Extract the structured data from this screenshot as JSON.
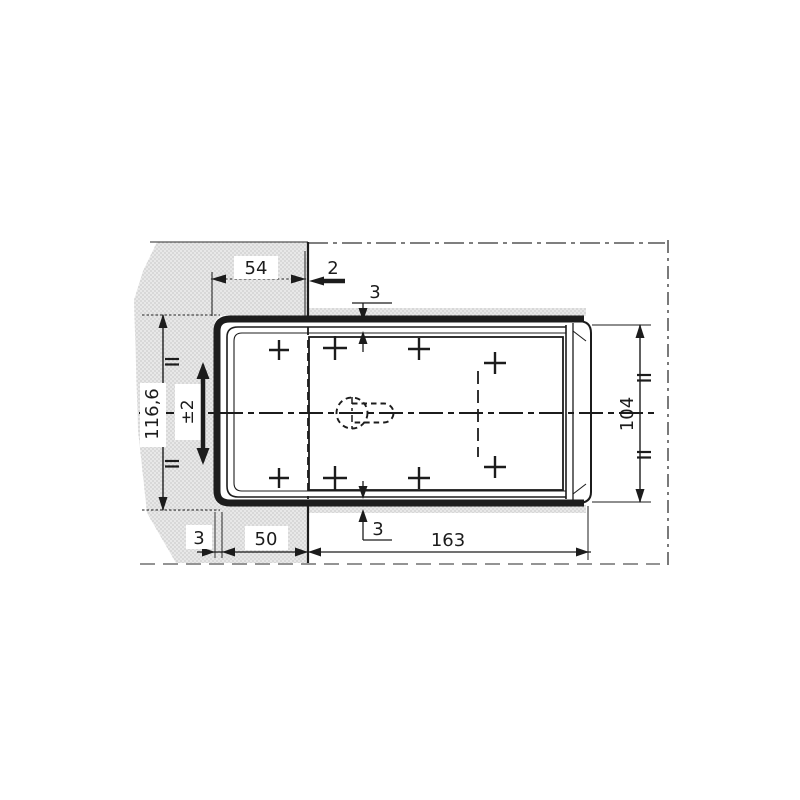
{
  "drawing": {
    "type": "technical-dimension-drawing",
    "description": "Sectioned installation drawing of a lamp housing channel mounted through a panel cutout",
    "labels": {
      "dim_54": "54",
      "dim_2": "2",
      "dim_3_top": "3",
      "dim_116_6": "116,6",
      "dim_pm2": "±2",
      "dim_104": "104",
      "dim_3_bottom": "3",
      "dim_3_left": "3",
      "dim_50": "50",
      "dim_163": "163"
    },
    "colors": {
      "line": "#1c1c1c",
      "panel_fill": "#e8e8e8",
      "panel_dot": "#9b9b9b",
      "background": "#ffffff"
    }
  }
}
